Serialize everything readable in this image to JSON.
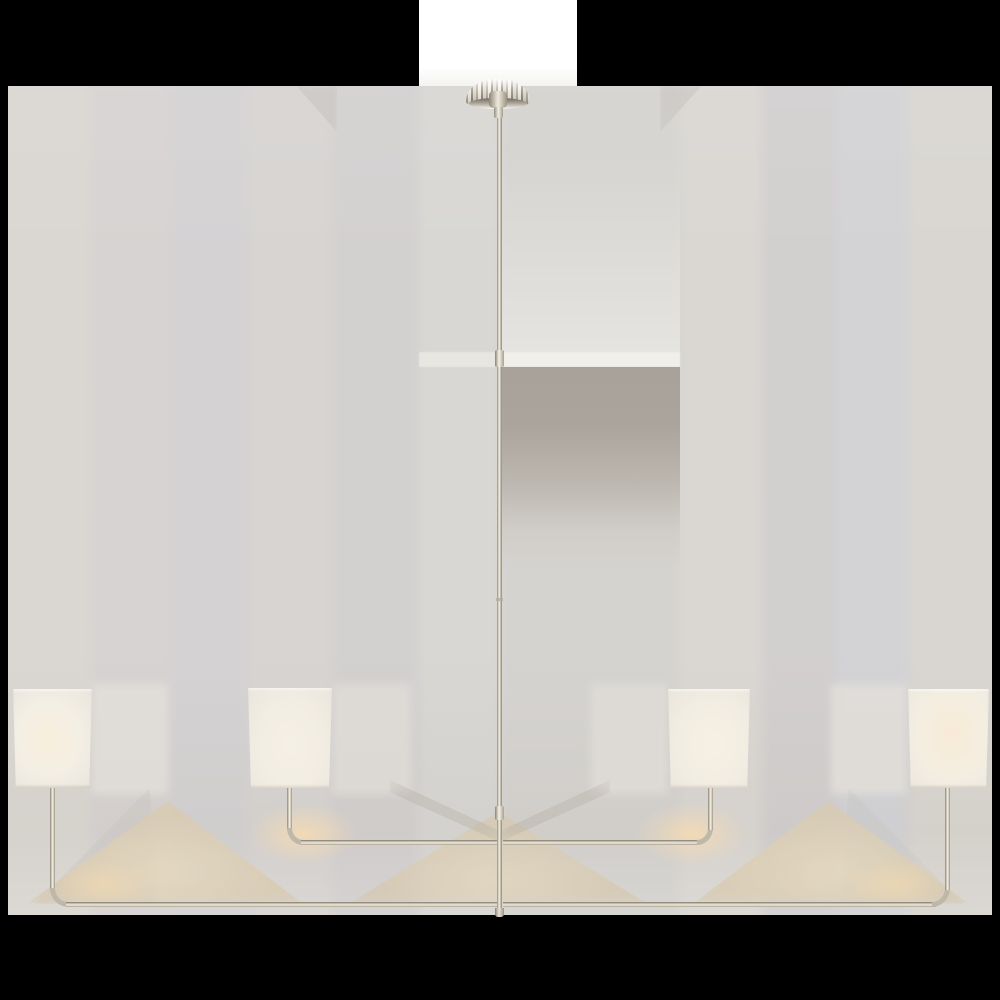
{
  "image_description": {
    "subject": "two-tier four-light linear chandelier product photo",
    "finish": "polished nickel",
    "shade_material": "white linen",
    "shade_count": 4,
    "backdrop": "light gray studio wall with soft cast shadows",
    "padding": "transparent border rendered black"
  },
  "colors": {
    "canvas_background": "#000000",
    "ceiling_white": "#ffffff",
    "wall_base": "#d6d3d1",
    "wall_band_blue": "#d3d3d6",
    "wall_band_pink": "#d2cfcf",
    "shade_linen": "#f3eee3",
    "shade_glow": "#f8ecd8",
    "metal_light": "#f2edde",
    "metal_mid": "#beb8aa",
    "metal_dark": "#7c7568",
    "shadow_tan": "#d9cbb1",
    "shadow_peach": "#f6dbb2",
    "shadow_taupe": "#a8a29a"
  },
  "scene": {
    "canvas": {
      "w": 1000,
      "h": 1000
    },
    "layers": [
      {
        "name": "ceiling-strip",
        "x": 419,
        "y": 0,
        "w": 158,
        "h": 87,
        "style": {
          "background": "linear-gradient(180deg,#ffffff 0%,#ffffff 78%,#f3f2ef 100%)"
        }
      },
      {
        "name": "backdrop-wall",
        "x": 8,
        "y": 86,
        "w": 984,
        "h": 829,
        "style": {
          "background": "linear-gradient(90deg,#dad7d2 0px,#dad7d2 74px,#d7d3d2 90px,#d7d3d2 154px,#d4d2d3 170px,#d4d2d3 232px,#d7d4d2 248px,#d7d4d2 316px,#d3d0d0 332px,#d3d0d0 402px,#d8d7d4 418px,#d8d7d4 484px,#d5d3d0 500px,#d5d3d0 664px,#dad7d3 680px,#dad7d3 746px,#d2cfcf 762px,#d2cfcf 822px,#d3d3d6 838px,#d3d3d6 892px,#d9d6d1 908px,#d9d6d1 984px)"
        }
      },
      {
        "name": "wall-tone-overlay",
        "x": 8,
        "y": 86,
        "w": 984,
        "h": 829,
        "style": {
          "background": "linear-gradient(180deg,rgba(255,255,255,0.06) 0%,rgba(255,255,255,0) 22%,rgba(0,0,0,0) 68%,rgba(152,140,120,0.07) 90%,rgba(255,255,255,0.05) 100%)"
        }
      },
      {
        "name": "canopy-shadow-wedge-left",
        "x": 293,
        "y": 86,
        "w": 44,
        "h": 46,
        "style": {
          "background": "#c6c3c0",
          "opacity": "0.55",
          "filter": "blur(3px)",
          "clipPath": "polygon(8% 0%,100% 0%,100% 100%)"
        }
      },
      {
        "name": "canopy-shadow-wedge-right",
        "x": 660,
        "y": 86,
        "w": 45,
        "h": 46,
        "style": {
          "background": "#c6c3c0",
          "opacity": "0.55",
          "filter": "blur(3px)",
          "clipPath": "polygon(0% 0%,92% 0%,0% 100%)"
        }
      },
      {
        "name": "center-light-column",
        "x": 500,
        "y": 150,
        "w": 180,
        "h": 205,
        "style": {
          "background": "linear-gradient(180deg,rgba(225,224,220,0) 0%,rgba(227,226,222,0.9) 80%,#e5e4e0 100%)"
        }
      },
      {
        "name": "highlight-stripe-left",
        "x": 419,
        "y": 352,
        "w": 81,
        "h": 15,
        "style": {
          "background": "#e7e6e0",
          "filter": "blur(0.5px)"
        }
      },
      {
        "name": "highlight-stripe-right",
        "x": 500,
        "y": 352,
        "w": 180,
        "h": 15,
        "style": {
          "background": "#f0efe9",
          "filter": "blur(0.5px)"
        }
      },
      {
        "name": "center-shadow-block",
        "x": 500,
        "y": 367,
        "w": 180,
        "h": 205,
        "style": {
          "background": "linear-gradient(180deg,#a8a29a 0%,#aaa49c 28%,rgba(178,172,163,0.75) 55%,rgba(200,195,187,0.35) 80%,rgba(210,206,199,0) 100%)"
        }
      },
      {
        "name": "shade-glow-column-outer-left",
        "x": 92,
        "y": 684,
        "w": 76,
        "h": 110,
        "style": {
          "background": "#e2dfda",
          "opacity": "0.85",
          "filter": "blur(4px)"
        }
      },
      {
        "name": "shade-glow-column-inner-left",
        "x": 333,
        "y": 684,
        "w": 78,
        "h": 110,
        "style": {
          "background": "#e0ddd8",
          "opacity": "0.8",
          "filter": "blur(4px)"
        }
      },
      {
        "name": "shade-glow-column-inner-right",
        "x": 591,
        "y": 684,
        "w": 77,
        "h": 110,
        "style": {
          "background": "#e0ddd8",
          "opacity": "0.8",
          "filter": "blur(4px)"
        }
      },
      {
        "name": "shade-glow-column-outer-right",
        "x": 831,
        "y": 684,
        "w": 75,
        "h": 110,
        "style": {
          "background": "#e2dfda",
          "opacity": "0.85",
          "filter": "blur(4px)"
        }
      },
      {
        "name": "wall-shadow-wedge-far-left",
        "x": 30,
        "y": 788,
        "w": 130,
        "h": 116,
        "style": {
          "background": "#c7c3bf",
          "opacity": "0.4",
          "filter": "blur(6px)",
          "clipPath": "polygon(92% 0%,4% 100%,98% 100%)"
        }
      },
      {
        "name": "wall-shadow-wedge-far-right",
        "x": 838,
        "y": 788,
        "w": 130,
        "h": 116,
        "style": {
          "background": "#c7c3bf",
          "opacity": "0.3",
          "filter": "blur(6px)",
          "clipPath": "polygon(8% 0%,2% 100%,96% 100%)"
        }
      },
      {
        "name": "arm-shadow-tent-outer-left",
        "x": 28,
        "y": 799,
        "w": 274,
        "h": 104,
        "style": {
          "background": "radial-gradient(ellipse at 50% 70%,#e7d9bd 0%,#d9cbb1 55%,#d5c9b2 100%)",
          "opacity": "0.8",
          "filter": "blur(5px)",
          "clipPath": "polygon(51% 2%,0% 100%,100% 100%)"
        }
      },
      {
        "name": "arm-shadow-tent-outer-right",
        "x": 694,
        "y": 799,
        "w": 274,
        "h": 104,
        "style": {
          "background": "radial-gradient(ellipse at 50% 70%,#e7d9bd 0%,#d9cbb1 55%,#d5c9b2 100%)",
          "opacity": "0.8",
          "filter": "blur(5px)",
          "clipPath": "polygon(49% 2%,0% 100%,100% 100%)"
        }
      },
      {
        "name": "arm-shadow-tent-center",
        "x": 350,
        "y": 810,
        "w": 296,
        "h": 93,
        "style": {
          "background": "radial-gradient(ellipse at 50% 75%,#e4d6bb 0%,#d5c8af 60%,#d2c6ae 100%)",
          "opacity": "0.75",
          "filter": "blur(5px)",
          "clipPath": "polygon(50% 2%,0% 100%,100% 100%)"
        }
      },
      {
        "name": "arm-shadow-band-left",
        "x": 390,
        "y": 780,
        "w": 110,
        "h": 62,
        "style": {
          "background": "#b3aca1",
          "opacity": "0.35",
          "filter": "blur(7px)",
          "clipPath": "polygon(0% 0%,100% 82%,100% 100%,0% 20%)"
        }
      },
      {
        "name": "arm-shadow-band-right",
        "x": 500,
        "y": 780,
        "w": 110,
        "h": 62,
        "style": {
          "background": "#b3aca1",
          "opacity": "0.35",
          "filter": "blur(7px)",
          "clipPath": "polygon(100% 0%,0% 82%,0% 100%,100% 20%)"
        }
      },
      {
        "name": "warm-glow-bend-inner-left",
        "x": 248,
        "y": 803,
        "w": 112,
        "h": 62,
        "style": {
          "background": "radial-gradient(ellipse at center,rgba(246,219,178,0.85) 0%,rgba(246,219,178,0) 70%)"
        }
      },
      {
        "name": "warm-glow-bend-inner-right",
        "x": 636,
        "y": 803,
        "w": 112,
        "h": 62,
        "style": {
          "background": "radial-gradient(ellipse at center,rgba(246,219,178,0.85) 0%,rgba(246,219,178,0) 70%)"
        }
      },
      {
        "name": "warm-glow-bend-outer-left",
        "x": 52,
        "y": 858,
        "w": 100,
        "h": 54,
        "style": {
          "background": "radial-gradient(ellipse at center,rgba(243,218,176,0.6) 0%,rgba(243,218,176,0) 70%)"
        }
      },
      {
        "name": "warm-glow-bend-outer-right",
        "x": 846,
        "y": 858,
        "w": 100,
        "h": 54,
        "style": {
          "background": "radial-gradient(ellipse at center,rgba(243,218,176,0.6) 0%,rgba(243,218,176,0) 70%)"
        }
      },
      {
        "name": "downrod",
        "x": 497,
        "y": 102,
        "w": 5,
        "h": 813,
        "style": {
          "background": "linear-gradient(90deg,#948d80 0%,#f4f0e4 45%,#c4beb0 70%,#8f887b 100%)"
        }
      },
      {
        "name": "rod-coupling-upper",
        "x": 495,
        "y": 350,
        "w": 9,
        "h": 17,
        "style": {
          "background": "linear-gradient(90deg,#8a8376,#f6f2e6 45%,#a89f8f)",
          "borderRadius": "2px"
        }
      },
      {
        "name": "rod-seam-mid",
        "x": 496,
        "y": 598,
        "w": 7,
        "h": 3,
        "style": {
          "background": "#b3ac9e",
          "opacity": "0.8"
        }
      },
      {
        "name": "rod-coupling-lower",
        "x": 495,
        "y": 806,
        "w": 9,
        "h": 14,
        "style": {
          "background": "linear-gradient(90deg,#8a8376,#f6f2e6 45%,#a89f8f)",
          "borderRadius": "2px"
        }
      },
      {
        "name": "rod-end-cap",
        "x": 495,
        "y": 908,
        "w": 9,
        "h": 9,
        "style": {
          "background": "linear-gradient(90deg,#8a8376,#e9e4d6 45%,#9a9384)",
          "borderRadius": "0 0 3px 3px"
        }
      },
      {
        "name": "arm-post-outer-left",
        "x": 50,
        "y": 786,
        "w": 5,
        "h": 104,
        "style": {
          "background": "linear-gradient(90deg,#8d8679 0%,#e9e4d5 45%,#f3eee1 55%,#9c9585 100%)"
        }
      },
      {
        "name": "arm-bend-outer-left",
        "x": 50,
        "y": 888,
        "w": 18,
        "h": 19,
        "style": {
          "borderLeft": "5px solid #beb8aa",
          "borderBottom": "5px solid #beb8aa",
          "borderBottomLeftRadius": "100% 100%",
          "boxSizing": "border-box"
        }
      },
      {
        "name": "arm-bar-outer-left",
        "x": 66,
        "y": 902,
        "w": 431,
        "h": 5,
        "style": {
          "background": "linear-gradient(180deg,#7c7568 0%,#b9b2a3 25%,#f1ecdd 60%,#a89f8e 100%)"
        }
      },
      {
        "name": "arm-post-inner-left",
        "x": 287,
        "y": 786,
        "w": 5,
        "h": 44,
        "style": {
          "background": "linear-gradient(90deg,#8d8679 0%,#e9e4d5 45%,#f3eee1 55%,#9c9585 100%)"
        }
      },
      {
        "name": "arm-bend-inner-left",
        "x": 287,
        "y": 828,
        "w": 16,
        "h": 17,
        "style": {
          "borderLeft": "5px solid #beb8aa",
          "borderBottom": "5px solid #beb8aa",
          "borderBottomLeftRadius": "100% 100%",
          "boxSizing": "border-box"
        }
      },
      {
        "name": "arm-bar-inner-left",
        "x": 301,
        "y": 840,
        "w": 196,
        "h": 5,
        "style": {
          "background": "linear-gradient(180deg,#7c7568 0%,#b9b2a3 25%,#f1ecdd 60%,#a89f8e 100%)"
        }
      },
      {
        "name": "arm-bar-inner-right",
        "x": 503,
        "y": 840,
        "w": 196,
        "h": 5,
        "style": {
          "background": "linear-gradient(180deg,#7c7568 0%,#b9b2a3 25%,#f1ecdd 60%,#a89f8e 100%)"
        }
      },
      {
        "name": "arm-bend-inner-right",
        "x": 697,
        "y": 828,
        "w": 16,
        "h": 17,
        "style": {
          "borderRight": "5px solid #beb8aa",
          "borderBottom": "5px solid #beb8aa",
          "borderBottomRightRadius": "100% 100%",
          "boxSizing": "border-box"
        }
      },
      {
        "name": "arm-post-inner-right",
        "x": 708,
        "y": 786,
        "w": 5,
        "h": 44,
        "style": {
          "background": "linear-gradient(90deg,#8d8679 0%,#e9e4d5 45%,#f3eee1 55%,#9c9585 100%)"
        }
      },
      {
        "name": "arm-bar-outer-right",
        "x": 503,
        "y": 902,
        "w": 433,
        "h": 5,
        "style": {
          "background": "linear-gradient(180deg,#7c7568 0%,#b9b2a3 25%,#f1ecdd 60%,#a89f8e 100%)"
        }
      },
      {
        "name": "arm-bend-outer-right",
        "x": 932,
        "y": 888,
        "w": 18,
        "h": 19,
        "style": {
          "borderRight": "5px solid #beb8aa",
          "borderBottom": "5px solid #beb8aa",
          "borderBottomRightRadius": "100% 100%",
          "boxSizing": "border-box"
        }
      },
      {
        "name": "arm-post-outer-right",
        "x": 945,
        "y": 786,
        "w": 5,
        "h": 104,
        "style": {
          "background": "linear-gradient(90deg,#8d8679 0%,#e9e4d5 45%,#f3eee1 55%,#9c9585 100%)"
        }
      },
      {
        "name": "canopy-dome",
        "x": 466,
        "y": 79,
        "w": 64,
        "h": 26,
        "style": {
          "background": "linear-gradient(180deg,rgba(255,255,255,0.95) 0%,rgba(255,255,255,0.35) 35%,rgba(120,112,100,0.18) 80%,rgba(90,84,74,0.3) 100%),repeating-linear-gradient(90deg,#a9a296 0px,#a9a296 2px,#f2eee2 2px,#f2eee2 5px,#867f72 5px,#867f72 7px,#ddd8ca 7px,#ddd8ca 10px)",
          "borderRadius": "50% 50% 12% 12% / 95% 95% 15% 15%"
        }
      },
      {
        "name": "canopy-rim",
        "x": 469,
        "y": 98,
        "w": 58,
        "h": 11,
        "style": {
          "background": "linear-gradient(180deg,#6f6a60 0%,#b5afa2 55%,#fbf8ef 100%)",
          "borderRadius": "50%"
        }
      },
      {
        "name": "canopy-hub",
        "x": 489,
        "y": 91,
        "w": 18,
        "h": 17,
        "style": {
          "background": "linear-gradient(90deg,#8d8679,#f0ebdc 50%,#9a9384)",
          "borderRadius": "25%"
        }
      },
      {
        "name": "stem-collar",
        "x": 494,
        "y": 107,
        "w": 9,
        "h": 11,
        "style": {
          "background": "linear-gradient(90deg,#958e81,#f3efe2 50%,#a39c8c)",
          "borderRadius": "2px"
        }
      },
      {
        "name": "lamp-shade-outer-left",
        "x": 13,
        "y": 689,
        "w": 79,
        "h": 99,
        "style": {
          "background": "radial-gradient(ellipse at 45% 50%,#f8eedb 0%,#f4efe4 50%,#ece8e0 85%,#e8e4dc 100%)",
          "clipPath": "polygon(0% 0%,100% 0%,96.5% 100%,3.5% 100%)",
          "boxShadow": "inset 0 -2px 2px rgba(170,160,145,0.35), inset 0 2px 2px rgba(255,255,255,0.5)"
        }
      },
      {
        "name": "lamp-shade-inner-left",
        "x": 248,
        "y": 688,
        "w": 84,
        "h": 100,
        "style": {
          "background": "radial-gradient(ellipse at 50% 58%,#f5f0e6 0%,#f2ede2 55%,#eae6de 100%)",
          "clipPath": "polygon(0% 0%,100% 0%,96.5% 100%,3.5% 100%)",
          "boxShadow": "inset 0 -2px 2px rgba(170,160,145,0.3), inset 0 2px 2px rgba(255,255,255,0.5)"
        }
      },
      {
        "name": "lamp-shade-inner-right",
        "x": 668,
        "y": 689,
        "w": 82,
        "h": 99,
        "style": {
          "background": "radial-gradient(ellipse at 55% 55%,#f6f0e4 0%,#f2ede2 55%,#eae6de 100%)",
          "clipPath": "polygon(0% 0%,100% 0%,96.5% 100%,3.5% 100%)",
          "boxShadow": "inset 0 -2px 2px rgba(170,160,145,0.3), inset 0 2px 2px rgba(255,255,255,0.5)"
        }
      },
      {
        "name": "lamp-shade-outer-right",
        "x": 908,
        "y": 689,
        "w": 81,
        "h": 99,
        "style": {
          "background": "radial-gradient(ellipse at 55% 45%,#f8ead6 0%,#f4eee1 55%,#ece8e0 100%)",
          "clipPath": "polygon(0% 0%,100% 0%,96.5% 100%,3.5% 100%)",
          "boxShadow": "inset 0 -2px 2px rgba(170,160,145,0.35), inset 0 2px 2px rgba(255,255,255,0.5)"
        }
      }
    ]
  }
}
